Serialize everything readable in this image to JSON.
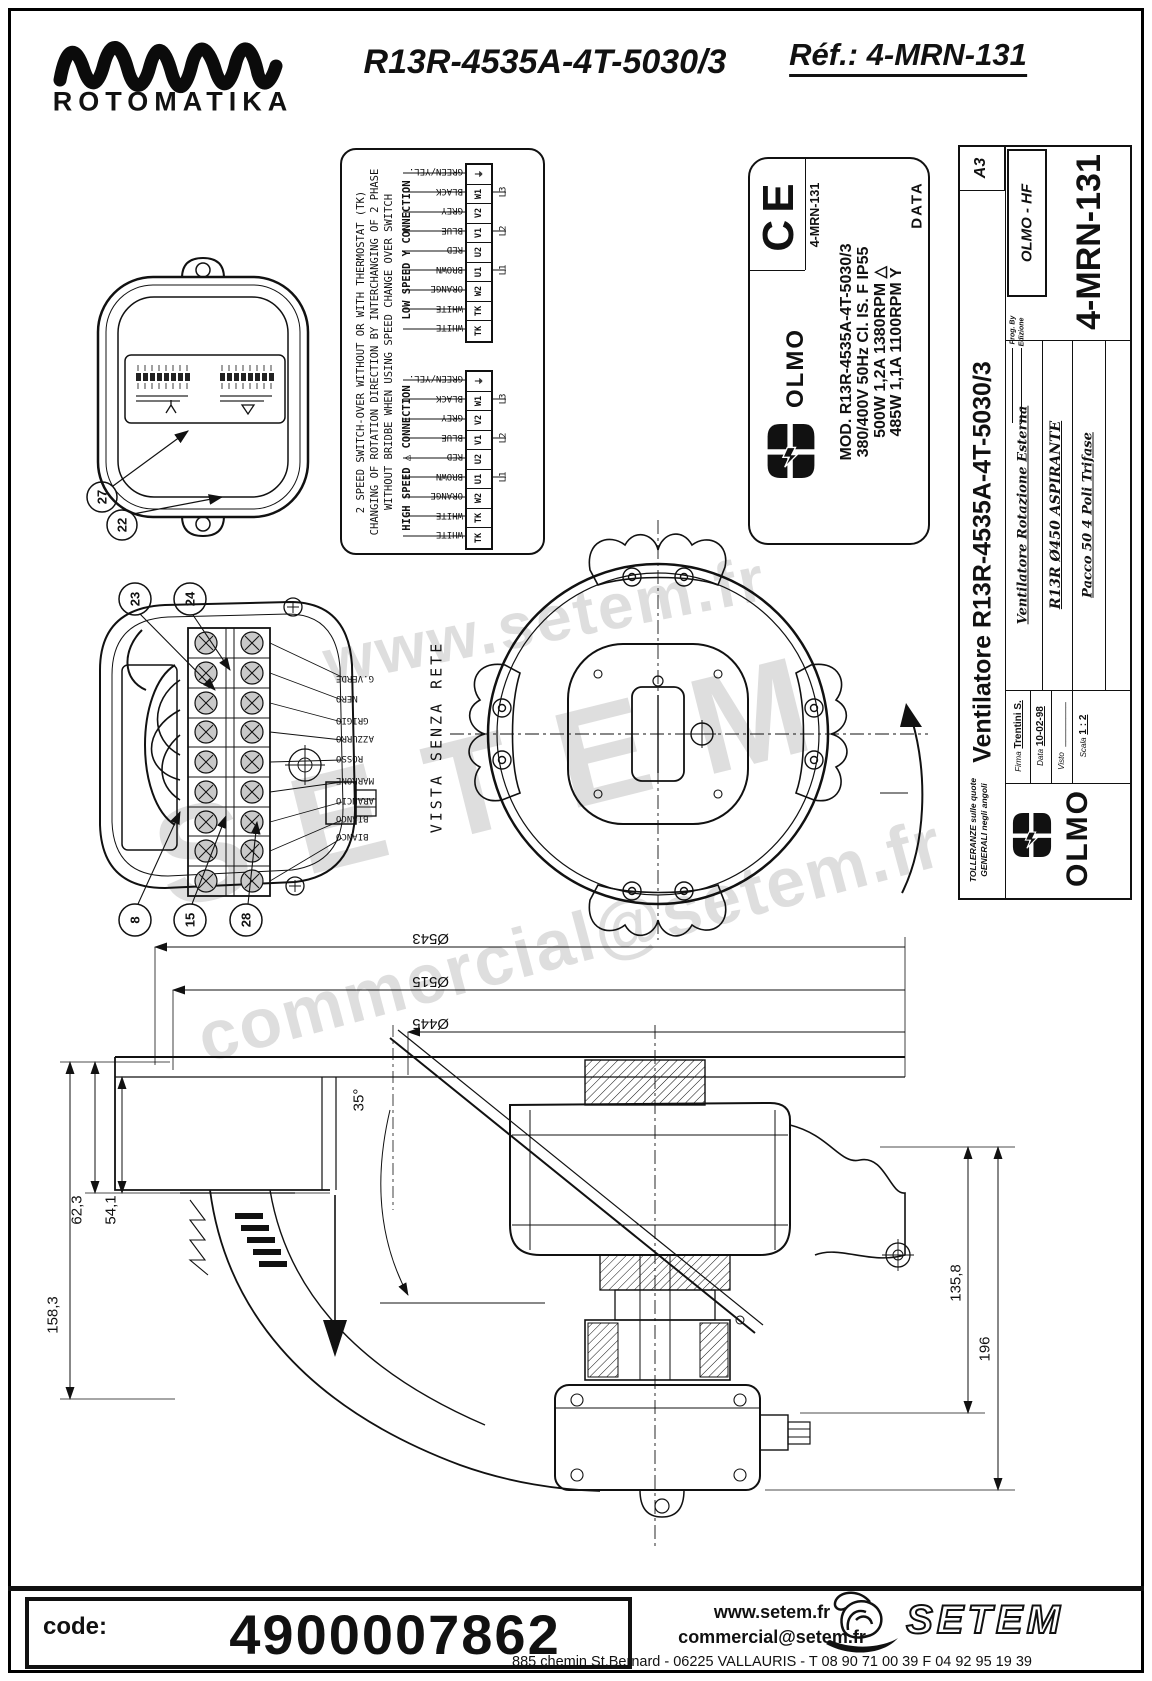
{
  "header": {
    "brand": "ROTOMATIKA",
    "title": "R13R-4535A-4T-5030/3",
    "ref": "Réf.: 4-MRN-131"
  },
  "watermarks": {
    "top": "www.setem.fr",
    "mid": "SETEM",
    "bottom": "commercial@setem.fr"
  },
  "wiring_note": {
    "line1": "2 SPEED SWITCH-OVER WITHOUT OR WITH THERMOSTAT (TK)",
    "line2": "CHANGING OF ROTATION DIRECTION BY INTERCHANGING OF 2 PHASE",
    "line3": "WITHOUT BRIDBE WHEN USING SPEED CHANGE OVER SWITCH",
    "low_label": "LOW SPEED Y CONNECTION",
    "high_label": "HIGH SPEED △ CONNECTION",
    "colors": [
      "GREEN/YEL.",
      "BLACK",
      "GREY",
      "BLUE",
      "RED",
      "BROWN",
      "ORANGE",
      "WHITE",
      "WHITE"
    ],
    "terminals": [
      "⏚",
      "W1",
      "V2",
      "V1",
      "U2",
      "U1",
      "W2",
      "TK",
      "TK"
    ],
    "phases": [
      "L3",
      "L2",
      "L1"
    ]
  },
  "balloons": {
    "closed": [
      "27",
      "22"
    ],
    "open_top": [
      "23",
      "24"
    ],
    "open_bottom": [
      "8",
      "15",
      "28"
    ]
  },
  "wire_labels": [
    "G.VERDE",
    "NERO",
    "GRIGIO",
    "AZZURRO",
    "ROSSO",
    "MARRONE",
    "ARANCIO",
    "BIANCO",
    "BIANCO"
  ],
  "front_view": {
    "caption": "VISTA SENZA RETE"
  },
  "data_label": {
    "ce": "CE",
    "ref": "4-MRN-131",
    "brand": "OLMO",
    "line1": "MOD. R13R-4535A-4T-5030/3",
    "line2": "380/400V  50Hz  Cl. IS. F  IP55",
    "line3": "500W  1,2A  1380RPM  △",
    "line4": "485W  1,1A  1100RPM  Y",
    "data_word": "DATA"
  },
  "title_block": {
    "format": "A3",
    "company": "OLMO - HF",
    "prog_by": "Prog. By",
    "edizione": "Edizione",
    "ref_large": "4-MRN-131",
    "title": "Ventilatore R13R-4535A-4T-5030/3",
    "row1": "Ventilatore Rotazione Esterna",
    "row2": "R13R Ø450 ASPIRANTE",
    "row3": "Pacco 50 4 Poli Trifase",
    "tol1": "TOLLERANZE  sulle quote",
    "tol2": "GENERALI  negli angoli",
    "firma_label": "Firma",
    "firma_value": "Trentini S.",
    "data_label": "Data",
    "data_value": "10-02-98",
    "visto_label": "Visto",
    "scala_label": "Scala",
    "scala_value": "1 : 2",
    "brand": "OLMO"
  },
  "dimensions": {
    "d1": "Ø543",
    "d2": "Ø515",
    "d3": "Ø445",
    "left1": "62,3",
    "left2": "54,1",
    "left3": "158,3",
    "right1": "135,8",
    "right2": "196",
    "angle": "35°"
  },
  "footer": {
    "code_label": "code:",
    "code_value": "4900007862",
    "web": "www.setem.fr",
    "email": "commercial@setem.fr",
    "address": "885 chemin St.Bernard  -  06225 VALLAURIS  -  T 08 90 71 00 39   F 04 92 95 19 39",
    "brand": "SETEM"
  }
}
